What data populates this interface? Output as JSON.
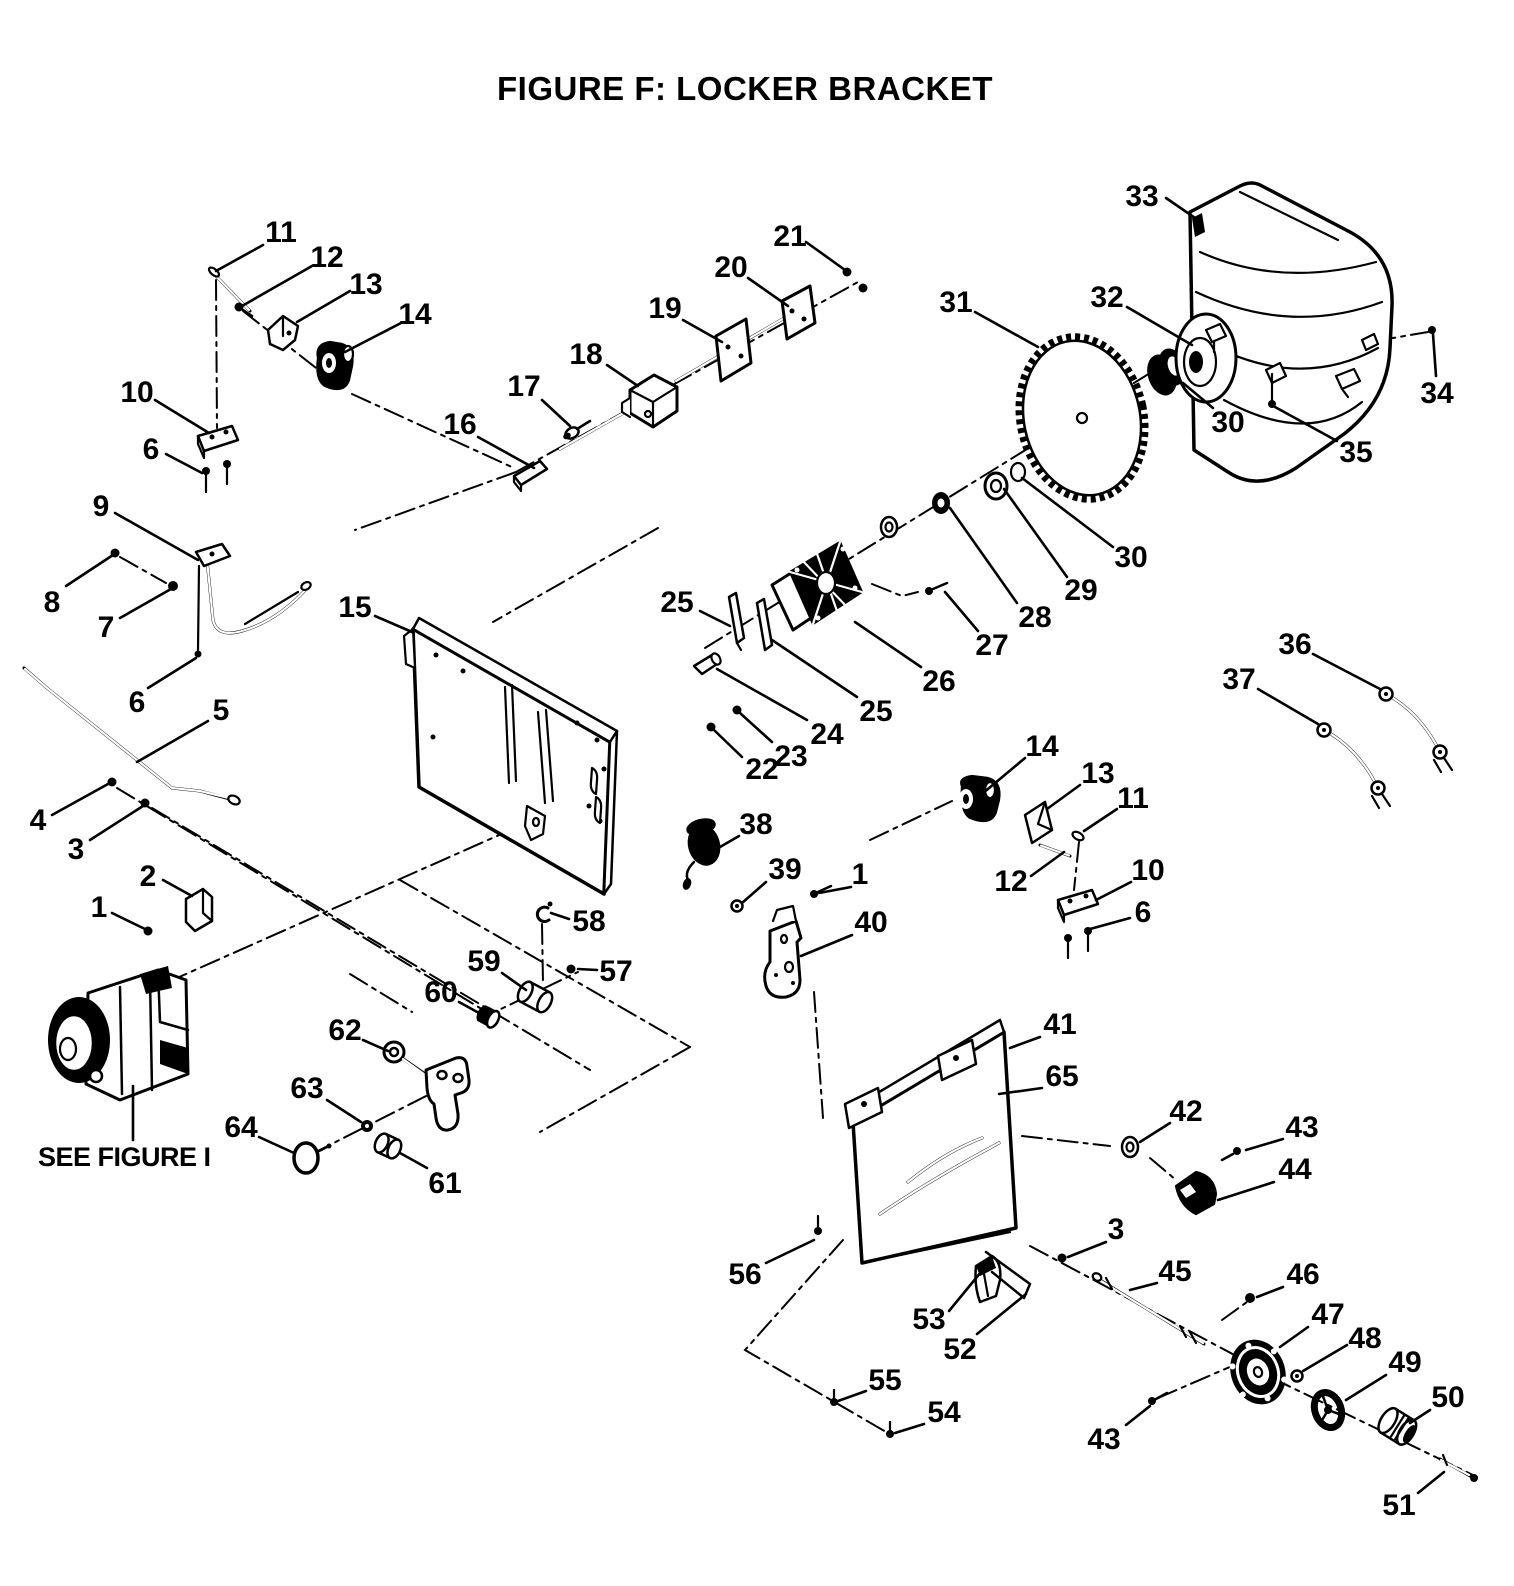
{
  "figure": {
    "title": "FIGURE F: LOCKER BRACKET"
  },
  "note": {
    "text": "SEE FIGURE I"
  },
  "colors": {
    "ink": "#000000",
    "paper": "#ffffff"
  },
  "callouts": [
    {
      "t": "11",
      "x": 281,
      "y": 231,
      "l": [
        263,
        245,
        216,
        271
      ]
    },
    {
      "t": "12",
      "x": 327,
      "y": 256,
      "l": [
        312,
        266,
        242,
        306
      ]
    },
    {
      "t": "13",
      "x": 366,
      "y": 283,
      "l": [
        350,
        291,
        297,
        322
      ]
    },
    {
      "t": "14",
      "x": 415,
      "y": 313,
      "l": [
        401,
        323,
        345,
        352
      ]
    },
    {
      "t": "10",
      "x": 137,
      "y": 391,
      "l": [
        155,
        400,
        209,
        433
      ]
    },
    {
      "t": "6",
      "x": 151,
      "y": 448,
      "l": [
        166,
        454,
        202,
        473
      ]
    },
    {
      "t": "9",
      "x": 101,
      "y": 505,
      "l": [
        115,
        513,
        198,
        560
      ]
    },
    {
      "t": "8",
      "x": 52,
      "y": 601,
      "l": [
        66,
        586,
        113,
        555
      ]
    },
    {
      "t": "7",
      "x": 106,
      "y": 626,
      "l": [
        120,
        618,
        171,
        589
      ]
    },
    {
      "t": "6",
      "x": 137,
      "y": 701,
      "l": [
        148,
        688,
        196,
        658
      ]
    },
    {
      "t": "15",
      "x": 355,
      "y": 606,
      "l": [
        375,
        616,
        412,
        632
      ]
    },
    {
      "t": "5",
      "x": 221,
      "y": 709,
      "l": [
        208,
        721,
        137,
        762
      ]
    },
    {
      "t": "4",
      "x": 38,
      "y": 819,
      "l": [
        52,
        815,
        108,
        784
      ]
    },
    {
      "t": "3",
      "x": 76,
      "y": 848,
      "l": [
        90,
        840,
        143,
        806
      ]
    },
    {
      "t": "2",
      "x": 148,
      "y": 875,
      "l": [
        163,
        880,
        192,
        896
      ]
    },
    {
      "t": "1",
      "x": 99,
      "y": 906,
      "l": [
        112,
        913,
        145,
        929
      ]
    },
    {
      "t": "16",
      "x": 460,
      "y": 423,
      "l": [
        478,
        437,
        534,
        468
      ]
    },
    {
      "t": "17",
      "x": 524,
      "y": 385,
      "l": [
        542,
        400,
        570,
        426
      ]
    },
    {
      "t": "18",
      "x": 586,
      "y": 353,
      "l": [
        607,
        365,
        638,
        386
      ]
    },
    {
      "t": "19",
      "x": 665,
      "y": 307,
      "l": [
        683,
        320,
        722,
        342
      ]
    },
    {
      "t": "20",
      "x": 731,
      "y": 266,
      "l": [
        748,
        278,
        788,
        306
      ]
    },
    {
      "t": "21",
      "x": 790,
      "y": 235,
      "l": [
        806,
        242,
        845,
        270
      ]
    },
    {
      "t": "31",
      "x": 956,
      "y": 301,
      "l": [
        975,
        312,
        1038,
        347
      ]
    },
    {
      "t": "32",
      "x": 1107,
      "y": 296,
      "l": [
        1127,
        307,
        1192,
        345
      ]
    },
    {
      "t": "33",
      "x": 1142,
      "y": 195,
      "l": [
        1166,
        198,
        1198,
        220
      ]
    },
    {
      "t": "34",
      "x": 1437,
      "y": 392,
      "l": [
        1436,
        376,
        1433,
        334
      ]
    },
    {
      "t": "30",
      "x": 1228,
      "y": 421,
      "l": [
        1213,
        408,
        1183,
        383
      ]
    },
    {
      "t": "35",
      "x": 1356,
      "y": 451,
      "l": [
        1337,
        441,
        1275,
        407
      ]
    },
    {
      "t": "30",
      "x": 1131,
      "y": 556,
      "l": [
        1113,
        547,
        1022,
        478
      ]
    },
    {
      "t": "29",
      "x": 1081,
      "y": 589,
      "l": [
        1067,
        577,
        1004,
        489
      ]
    },
    {
      "t": "28",
      "x": 1035,
      "y": 616,
      "l": [
        1017,
        603,
        950,
        508
      ]
    },
    {
      "t": "27",
      "x": 992,
      "y": 644,
      "l": [
        978,
        631,
        945,
        592
      ]
    },
    {
      "t": "26",
      "x": 939,
      "y": 680,
      "l": [
        921,
        667,
        855,
        622
      ]
    },
    {
      "t": "25",
      "x": 677,
      "y": 601,
      "l": [
        700,
        611,
        730,
        626
      ]
    },
    {
      "t": "25",
      "x": 876,
      "y": 710,
      "l": [
        857,
        697,
        772,
        640
      ]
    },
    {
      "t": "24",
      "x": 827,
      "y": 733,
      "l": [
        807,
        720,
        717,
        669
      ]
    },
    {
      "t": "23",
      "x": 791,
      "y": 755,
      "l": [
        772,
        742,
        740,
        713
      ]
    },
    {
      "t": "22",
      "x": 762,
      "y": 768,
      "l": [
        742,
        757,
        714,
        730
      ]
    },
    {
      "t": "36",
      "x": 1295,
      "y": 643,
      "l": [
        1313,
        654,
        1380,
        689
      ]
    },
    {
      "t": "37",
      "x": 1239,
      "y": 678,
      "l": [
        1258,
        689,
        1318,
        724
      ]
    },
    {
      "t": "14",
      "x": 1042,
      "y": 745,
      "l": [
        1025,
        758,
        976,
        799
      ]
    },
    {
      "t": "13",
      "x": 1098,
      "y": 772,
      "l": [
        1080,
        785,
        1047,
        809
      ]
    },
    {
      "t": "11",
      "x": 1133,
      "y": 797,
      "l": [
        1117,
        809,
        1084,
        831
      ]
    },
    {
      "t": "12",
      "x": 1011,
      "y": 880,
      "l": [
        1031,
        876,
        1064,
        852
      ]
    },
    {
      "t": "10",
      "x": 1148,
      "y": 869,
      "l": [
        1131,
        882,
        1096,
        900
      ]
    },
    {
      "t": "6",
      "x": 1143,
      "y": 911,
      "l": [
        1130,
        918,
        1090,
        929
      ]
    },
    {
      "t": "38",
      "x": 756,
      "y": 823,
      "l": [
        739,
        836,
        720,
        847
      ]
    },
    {
      "t": "39",
      "x": 785,
      "y": 868,
      "l": [
        766,
        882,
        742,
        903
      ]
    },
    {
      "t": "1",
      "x": 860,
      "y": 873,
      "l": [
        851,
        887,
        819,
        893
      ]
    },
    {
      "t": "40",
      "x": 871,
      "y": 921,
      "l": [
        852,
        935,
        801,
        956
      ]
    },
    {
      "t": "58",
      "x": 589,
      "y": 920,
      "l": [
        569,
        919,
        551,
        913
      ]
    },
    {
      "t": "59",
      "x": 484,
      "y": 960,
      "l": [
        502,
        973,
        526,
        990
      ]
    },
    {
      "t": "57",
      "x": 616,
      "y": 970,
      "l": [
        597,
        970,
        578,
        969
      ]
    },
    {
      "t": "60",
      "x": 441,
      "y": 991,
      "l": [
        459,
        1002,
        479,
        1013
      ]
    },
    {
      "t": "62",
      "x": 345,
      "y": 1029,
      "l": [
        363,
        1040,
        388,
        1051
      ]
    },
    {
      "t": "63",
      "x": 307,
      "y": 1087,
      "l": [
        327,
        1100,
        361,
        1122
      ]
    },
    {
      "t": "64",
      "x": 241,
      "y": 1126,
      "l": [
        259,
        1137,
        294,
        1153
      ]
    },
    {
      "t": "61",
      "x": 445,
      "y": 1182,
      "l": [
        427,
        1168,
        400,
        1153
      ]
    },
    {
      "t": "41",
      "x": 1060,
      "y": 1023,
      "l": [
        1040,
        1037,
        1010,
        1048
      ]
    },
    {
      "t": "65",
      "x": 1062,
      "y": 1075,
      "l": [
        1042,
        1088,
        999,
        1094
      ]
    },
    {
      "t": "42",
      "x": 1186,
      "y": 1110,
      "l": [
        1170,
        1123,
        1140,
        1142
      ]
    },
    {
      "t": "43",
      "x": 1302,
      "y": 1126,
      "l": [
        1283,
        1139,
        1246,
        1150
      ]
    },
    {
      "t": "44",
      "x": 1295,
      "y": 1168,
      "l": [
        1274,
        1182,
        1218,
        1200
      ]
    },
    {
      "t": "3",
      "x": 1116,
      "y": 1228,
      "l": [
        1106,
        1242,
        1068,
        1257
      ]
    },
    {
      "t": "45",
      "x": 1175,
      "y": 1270,
      "l": [
        1157,
        1283,
        1130,
        1290
      ]
    },
    {
      "t": "46",
      "x": 1303,
      "y": 1273,
      "l": [
        1283,
        1287,
        1257,
        1297
      ]
    },
    {
      "t": "47",
      "x": 1328,
      "y": 1313,
      "l": [
        1308,
        1327,
        1280,
        1347
      ]
    },
    {
      "t": "48",
      "x": 1365,
      "y": 1337,
      "l": [
        1347,
        1345,
        1303,
        1371
      ]
    },
    {
      "t": "49",
      "x": 1405,
      "y": 1361,
      "l": [
        1386,
        1375,
        1346,
        1400
      ]
    },
    {
      "t": "50",
      "x": 1448,
      "y": 1396,
      "l": [
        1430,
        1410,
        1410,
        1423
      ]
    },
    {
      "t": "51",
      "x": 1399,
      "y": 1504,
      "l": [
        1418,
        1493,
        1444,
        1472
      ]
    },
    {
      "t": "43",
      "x": 1104,
      "y": 1438,
      "l": [
        1126,
        1425,
        1150,
        1406
      ]
    },
    {
      "t": "56",
      "x": 745,
      "y": 1273,
      "l": [
        766,
        1263,
        814,
        1240
      ]
    },
    {
      "t": "53",
      "x": 929,
      "y": 1318,
      "l": [
        949,
        1311,
        981,
        1272
      ]
    },
    {
      "t": "52",
      "x": 960,
      "y": 1348,
      "l": [
        977,
        1334,
        1026,
        1294
      ]
    },
    {
      "t": "55",
      "x": 885,
      "y": 1379,
      "l": [
        866,
        1391,
        838,
        1401
      ]
    },
    {
      "t": "54",
      "x": 944,
      "y": 1411,
      "l": [
        924,
        1424,
        895,
        1433
      ]
    }
  ]
}
